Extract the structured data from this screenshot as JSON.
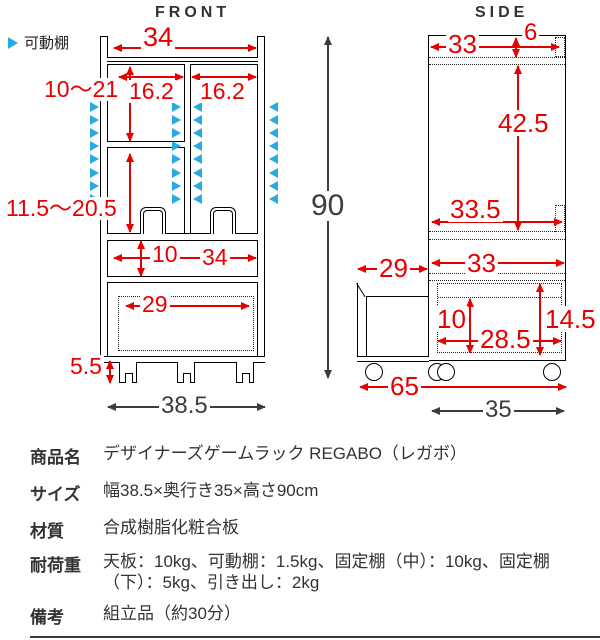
{
  "titles": {
    "front": "FRONT",
    "side": "SIDE"
  },
  "legend": {
    "label": "可動棚"
  },
  "colors": {
    "red": "#e60000",
    "blue": "#29abe2",
    "dark": "#3d3d3d"
  },
  "front": {
    "dims": {
      "top_width": "34",
      "upper_shelf_range": "10〜21",
      "left_inner_width": "16.2",
      "right_inner_width": "16.2",
      "lower_shelf_range": "11.5〜20.5",
      "slot_height": "10",
      "slot_width": "34",
      "drawer_width": "29",
      "leg_height": "5.5",
      "total_height": "90",
      "total_width": "38.5"
    }
  },
  "side": {
    "dims": {
      "top_depth": "33",
      "top_back_offset": "6",
      "upper_height": "42.5",
      "mid_depth": "33.5",
      "lower_depth": "33",
      "pullout_depth": "29",
      "drawer_inner_height": "10",
      "drawer_inner_depth": "28.5",
      "drawer_height": "14.5",
      "total_depth_with_drawer": "65",
      "total_depth": "35"
    }
  },
  "spec_table": {
    "rows": [
      {
        "label": "商品名",
        "value": "デザイナーズゲームラック REGABO（レガボ）"
      },
      {
        "label": "サイズ",
        "value": "幅38.5×奥行き35×高さ90cm"
      },
      {
        "label": "材質",
        "value": "合成樹脂化粧合板"
      },
      {
        "label": "耐荷重",
        "value": "天板：10kg、可動棚：1.5kg、固定棚（中）：10kg、固定棚（下）：5kg、引き出し：2kg"
      },
      {
        "label": "備考",
        "value": "組立品（約30分）"
      }
    ]
  }
}
